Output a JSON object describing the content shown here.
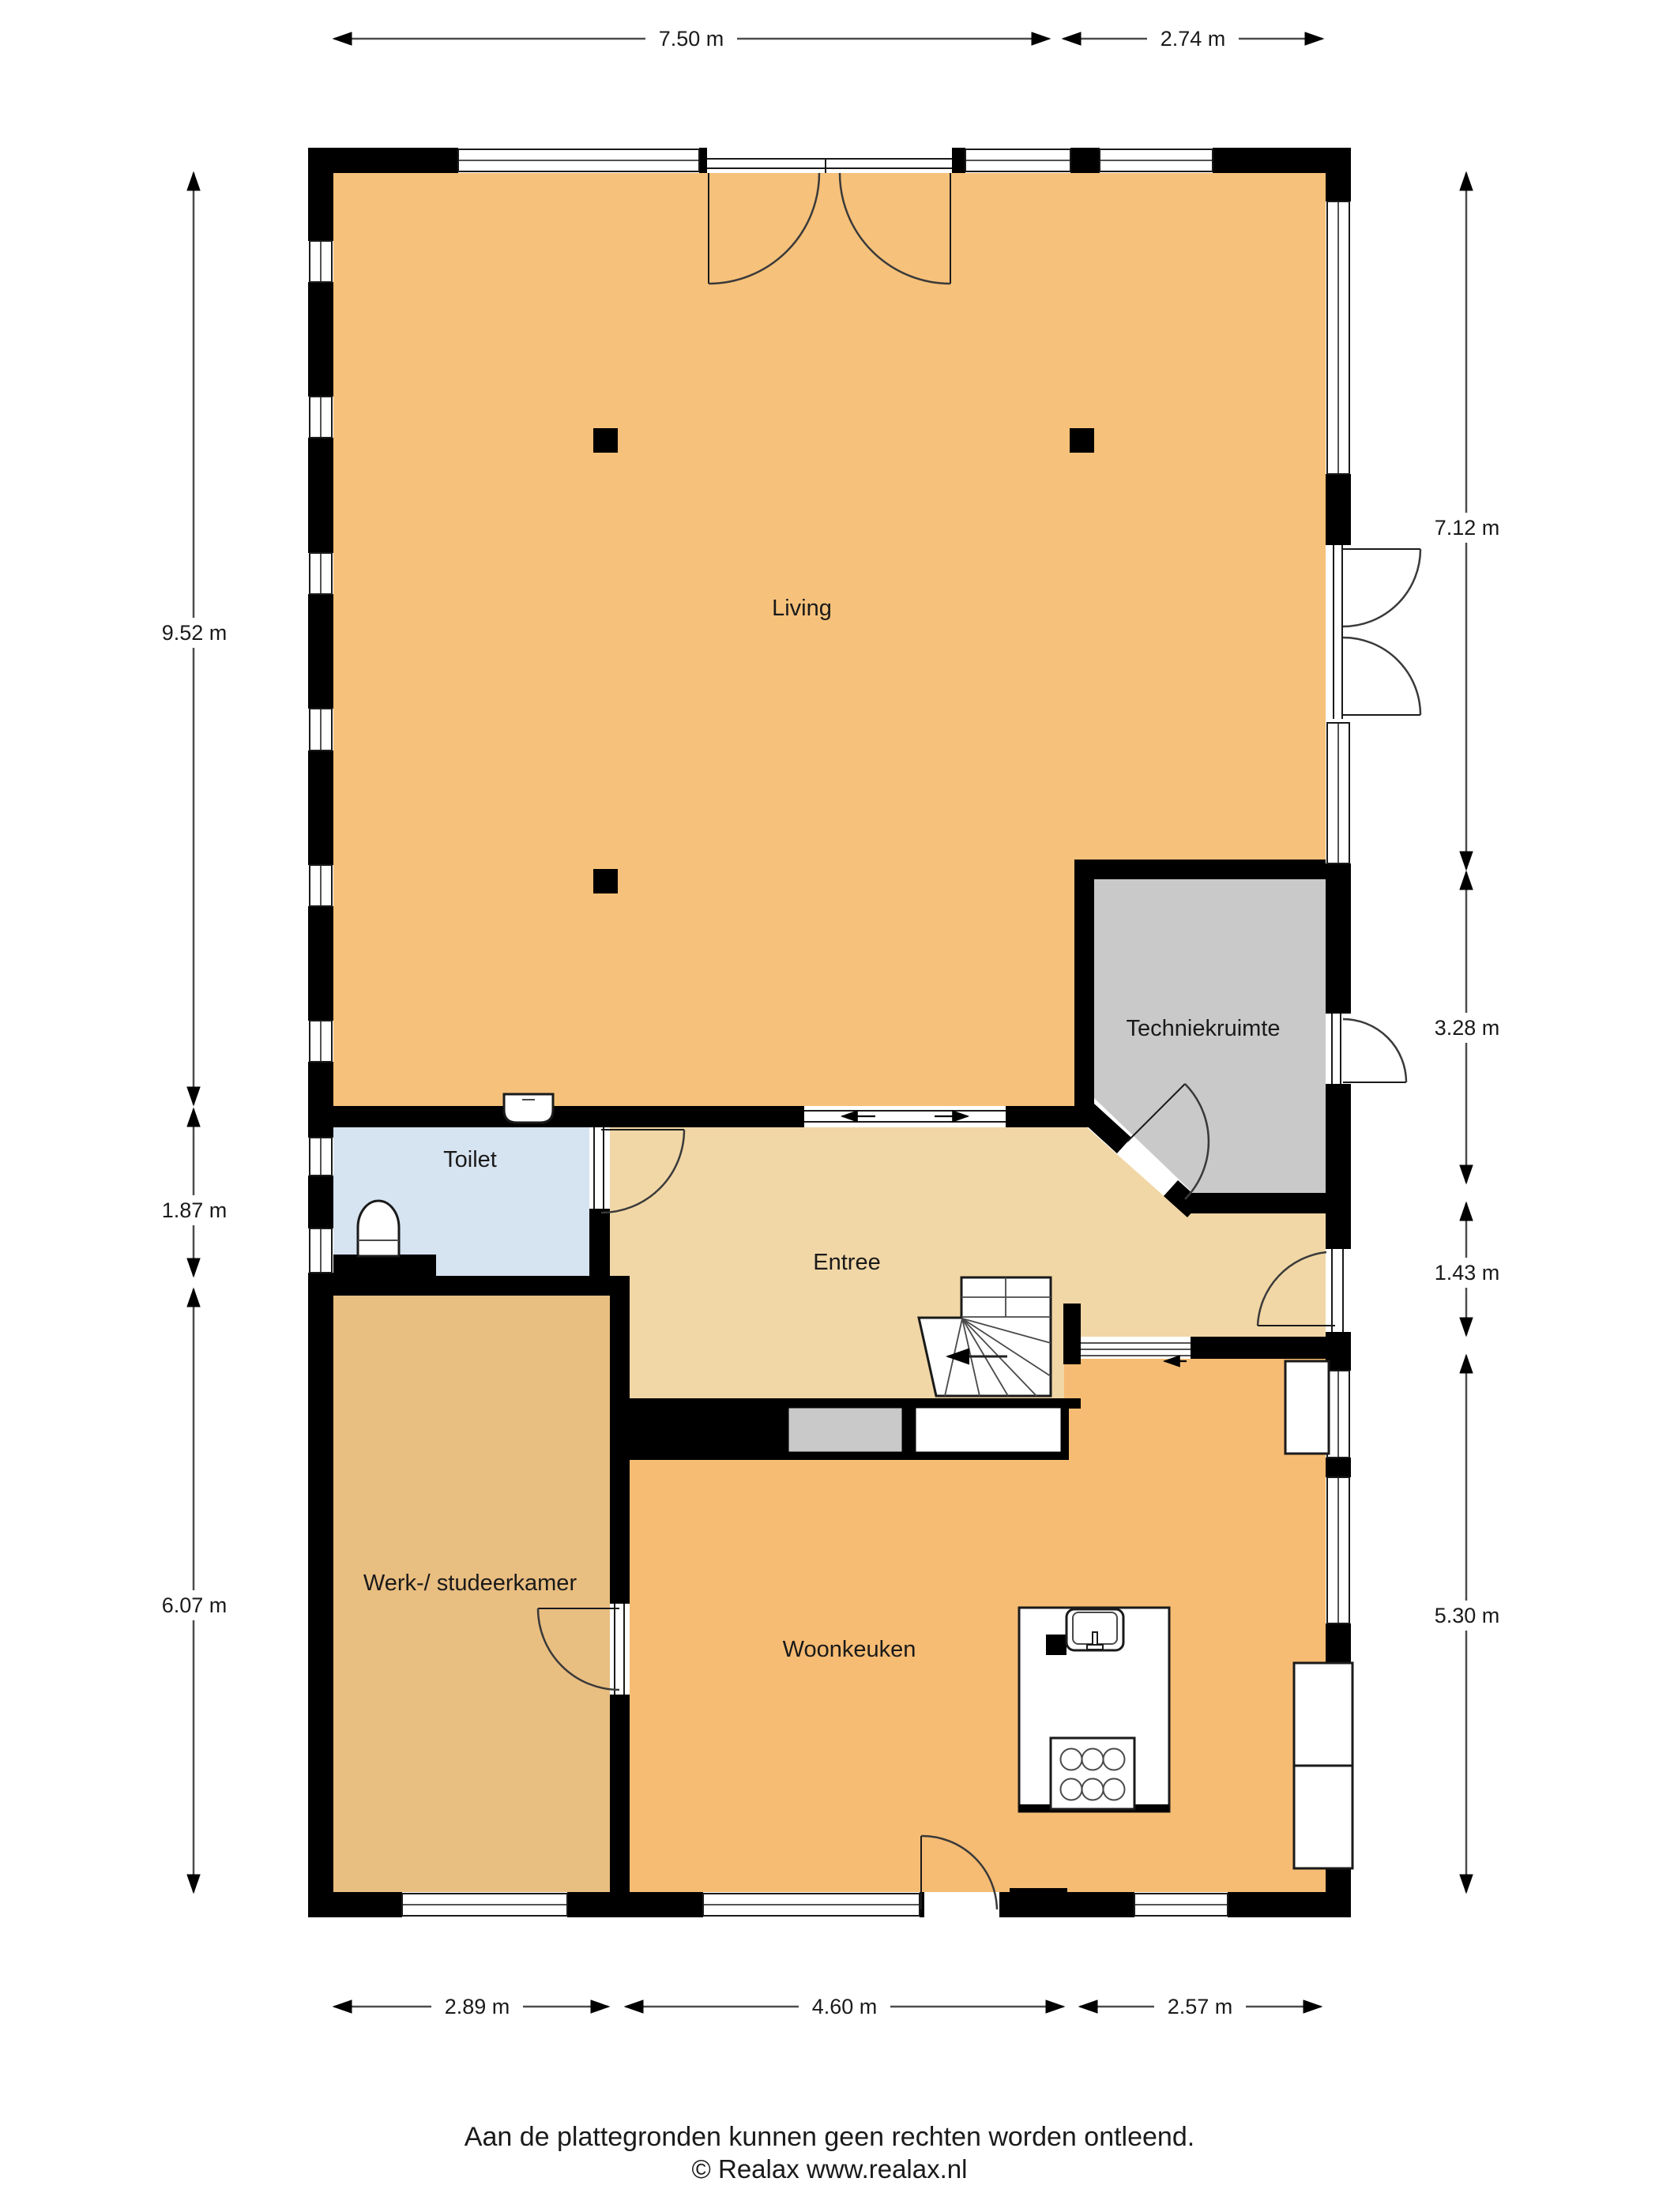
{
  "footer": {
    "line1": "Aan de plattegronden kunnen geen rechten worden ontleend.",
    "line2": "© Realax www.realax.nl"
  },
  "rooms": {
    "living": {
      "label": "Living"
    },
    "techniekruimte": {
      "label": "Techniekruimte"
    },
    "toilet": {
      "label": "Toilet"
    },
    "entree": {
      "label": "Entree"
    },
    "werkkamer": {
      "label": "Werk-/ studeerkamer"
    },
    "woonkeuken": {
      "label": "Woonkeuken"
    }
  },
  "dimensions": {
    "top": [
      "7.50 m",
      "2.74 m"
    ],
    "left": [
      "9.52 m",
      "1.87 m",
      "6.07 m"
    ],
    "right": [
      "7.12 m",
      "3.28 m",
      "1.43 m",
      "5.30 m"
    ],
    "bottom": [
      "2.89 m",
      "4.60 m",
      "2.57 m"
    ]
  },
  "colors": {
    "living": "#F6C17A",
    "woonkeuken": "#F6BC73",
    "werk": "#E9BE81",
    "entree": "#F1D7A6",
    "toilet": "#D6E3F1",
    "techniek": "#C9C9C9",
    "wall": "#000000",
    "dimline": "#4D4D4D",
    "text": "#1A1A1A"
  }
}
